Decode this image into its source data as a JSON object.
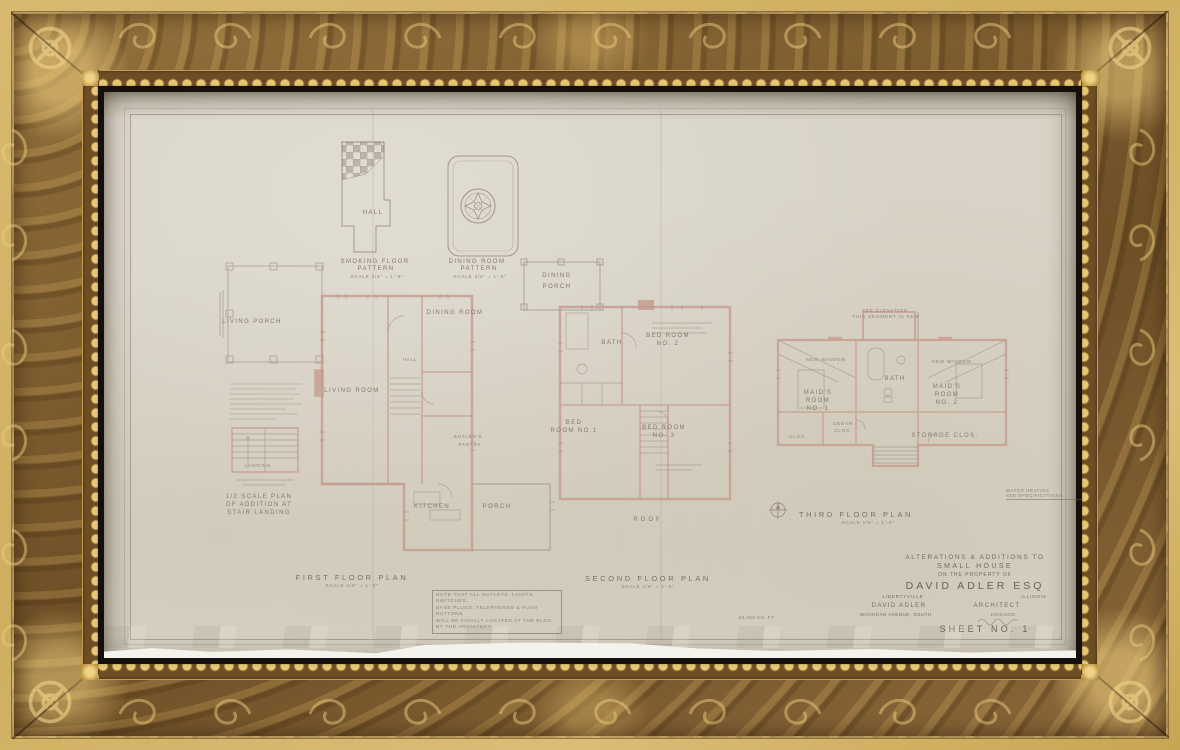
{
  "artwork": {
    "description": "Framed architectural blueprint drawing"
  },
  "colors": {
    "frame_gold": "#cfae5f",
    "frame_brown": "#7d5c2f",
    "bead_gold": "#e8c873",
    "inner_black": "#15100b",
    "paper": "#d8d3c6",
    "wall_pink": "#c59a8d",
    "ink": "#837869"
  },
  "patterns": {
    "hall_label": "HALL",
    "smoking_line1": "SMOKING FLOOR",
    "smoking_line2": "PATTERN",
    "smoking_scale": "SCALE  3/4\" = 1'-0\"",
    "dining_line1": "DINING ROOM",
    "dining_line2": "PATTERN",
    "dining_scale": "SCALE  3/4\" = 1'-0\""
  },
  "plans": {
    "first": {
      "label": "FIRST  FLOOR  PLAN",
      "scale": "SCALE  1/8\" = 1'-0\"",
      "rooms": {
        "living_porch": "LIVING  PORCH",
        "living_room": "LIVING  ROOM",
        "hall": "HALL",
        "dining_room": "DINING  ROOM",
        "butlers1": "BUTLER'S",
        "butlers2": "PANTRY",
        "kitchen": "KITCHEN",
        "porch": "PORCH",
        "dining_porch1": "DINING",
        "dining_porch2": "PORCH"
      }
    },
    "second": {
      "label": "SECOND  FLOOR  PLAN",
      "scale": "SCALE  1/8\" = 1'-0\"",
      "rooms": {
        "bath": "BATH",
        "bed2a": "BED ROOM",
        "bed2b": "NO. 2",
        "bed1a": "BED",
        "bed1b": "ROOM NO.1",
        "bed3a": "BED ROOM",
        "bed3b": "NO. 3",
        "roof": "ROOF"
      }
    },
    "third": {
      "label": "THIRD  FLOOR  PLAN",
      "scale": "SCALE  1/8\" = 1'-0\"",
      "note1": "SEE ELEVATION",
      "note2": "THIS SEGMENT IS NEW",
      "new_window_left": "NEW WINDOW",
      "new_window_right": "NEW WINDOW",
      "rooms": {
        "m1a": "MAID'S",
        "m1b": "ROOM",
        "m1c": "NO. 1",
        "bath": "BATH",
        "m2a": "MAID'S",
        "m2b": "ROOM",
        "m2c": "NO. 2",
        "cedar1": "CEDAR",
        "cedar2": "CLOS.",
        "storage": "STORAGE  CLOS.",
        "clos": "CLOS."
      }
    }
  },
  "stair_inset": {
    "landing": "LANDING",
    "cap1": "1/2 SCALE PLAN",
    "cap2": "OF ADDITION AT",
    "cap3": "STAIR LANDING"
  },
  "note_box": {
    "lines": [
      "NOTE THAT ALL OUTLETS, LIGHTS, SWITCHES,",
      "BASE PLUGS, TELEPHONES & PUSH BUTTONS",
      "WILL BE FINALLY LOCATED AT THE BLDG.",
      "BY THE ARCHITECT."
    ]
  },
  "titleblock": {
    "project_line1": "ALTERATIONS & ADDITIONS TO",
    "project_line2": "SMALL  HOUSE",
    "project_line3": "ON THE PROPERTY OF",
    "owner": "DAVID  ADLER  ESQ",
    "owner_city": "LIBERTYVILLE",
    "owner_state": "ILLINOIS",
    "architect_name": "DAVID ADLER",
    "architect_title": "ARCHITECT",
    "architect_address": "MICHIGAN AVENUE, SOUTH",
    "architect_city": "CHICAGO",
    "sheet": "SHEET  NO. 1"
  },
  "misc": {
    "volume_note": "52,000 CU. FT.",
    "corner_note1": "WATER HEATING",
    "corner_note2": "SEE SPECIFICATIONS"
  }
}
